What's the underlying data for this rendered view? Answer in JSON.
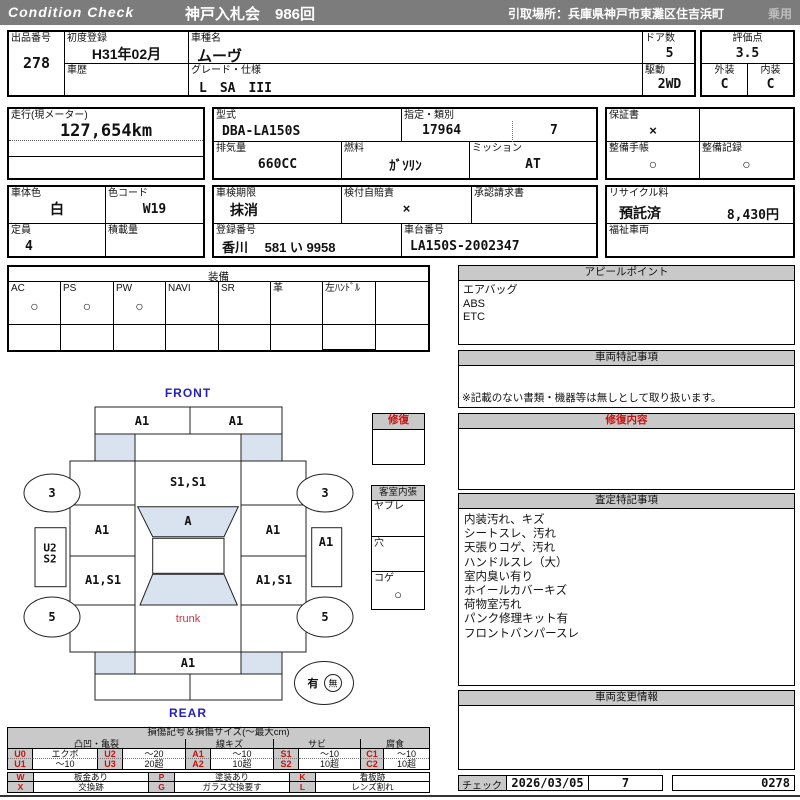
{
  "header": {
    "brand": "Condition  Check",
    "auction": "神戸入札会　986回",
    "pickup": "引取場所：兵庫県神戸市東灘区住吉浜町",
    "category": "乗用"
  },
  "info": {
    "lot_label": "出品番号",
    "lot": "278",
    "first_reg_label": "初度登録",
    "first_reg": "H31年02月",
    "history_label": "車歴",
    "model_name_label": "車種名",
    "model_name": "ムーヴ",
    "grade_label": "グレード・仕様",
    "grade": "L　SA　III",
    "doors_label": "ドア数",
    "doors": "5",
    "drive_label": "駆動",
    "drive": "2WD",
    "score_label": "評価点",
    "score": "3.5",
    "exterior_label": "外装",
    "exterior": "C",
    "interior_label": "内装",
    "interior": "C",
    "mileage_label": "走行(現メーター)",
    "mileage": "127,654km",
    "model_code_label": "型式",
    "model_code": "DBA-LA150S",
    "class_label": "指定・類別",
    "class_1": "17964",
    "class_2": "7",
    "warranty_label": "保証書",
    "warranty": "×",
    "displacement_label": "排気量",
    "displacement": "660CC",
    "fuel_label": "燃料",
    "fuel": "ｶﾞｿﾘﾝ",
    "transmission_label": "ミッション",
    "transmission": "AT",
    "maintenance_book_label": "整備手帳",
    "maintenance_book": "○",
    "maintenance_record_label": "整備記録",
    "maintenance_record": "○",
    "color_label": "車体色",
    "color": "白",
    "color_code_label": "色コード",
    "color_code": "W19",
    "inspection_label": "車検期限",
    "inspection": "抹消",
    "insurance_label": "検付自賠責",
    "insurance": "×",
    "approval_label": "承認請求書",
    "recycle_label": "リサイクル料",
    "recycle_status": "預託済",
    "recycle_fee": "8,430円",
    "capacity_label": "定員",
    "capacity": "4",
    "load_label": "積載量",
    "reg_no_label": "登録番号",
    "reg_no": "香川　 581 い  9958",
    "chassis_label": "車台番号",
    "chassis": "LA150S-2002347",
    "welfare_label": "福祉車両"
  },
  "equipment": {
    "title": "装備",
    "items": [
      {
        "label": "AC",
        "value": "○"
      },
      {
        "label": "PS",
        "value": "○"
      },
      {
        "label": "PW",
        "value": "○"
      },
      {
        "label": "NAVI",
        "value": ""
      },
      {
        "label": "SR",
        "value": ""
      },
      {
        "label": "革",
        "value": ""
      },
      {
        "label": "左ﾊﾝﾄﾞﾙ",
        "value": ""
      },
      {
        "label": "",
        "value": ""
      }
    ]
  },
  "panels": {
    "appeal": {
      "title": "アピールポイント",
      "line1": "エアバッグ",
      "line2": "ABS",
      "line3": "ETC"
    },
    "special": {
      "title": "車両特記事項",
      "note": "※記載のない書類・機器等は無しとして取り扱います。"
    },
    "repair": {
      "title": "修復内容"
    },
    "assessment": {
      "title": "査定特記事項",
      "lines": [
        "内装汚れ、キズ",
        "シートスレ、汚れ",
        "天張りコゲ、汚れ",
        "ハンドルスレ（大）",
        "室内臭い有り",
        "ホイールカバーキズ",
        "荷物室汚れ",
        "パンク修理キット有",
        "フロントバンパースレ"
      ]
    },
    "change": {
      "title": "車両変更情報"
    },
    "check": {
      "label": "チェック",
      "date": "2026/03/05",
      "num": "7",
      "code": "0278"
    }
  },
  "diagram": {
    "front_label": "FRONT",
    "rear_label": "REAR",
    "bumper_fl": "A1",
    "bumper_fr": "A1",
    "windshield": "S1,S1",
    "door_fl": "A1",
    "roof": "A",
    "door_fr": "A1",
    "door_rl": "A1,S1",
    "door_rr": "A1,S1",
    "sill_l1": "U2",
    "sill_l2": "S2",
    "sill_r": "A1",
    "wheel_fl": "3",
    "wheel_fr": "3",
    "wheel_rl": "5",
    "wheel_rr": "5",
    "trunk": "trunk",
    "rear_panel": "A1",
    "tools_yes": "有",
    "tools_no": "無",
    "repair_box_title": "修復",
    "cabin_title": "客室内張",
    "cabin_rows": [
      {
        "label": "ヤブレ",
        "value": ""
      },
      {
        "label": "穴",
        "value": ""
      },
      {
        "label": "コゲ",
        "value": "○"
      }
    ]
  },
  "legend": {
    "title": "損傷記号＆損傷サイズ(～最大cm)",
    "groups": [
      "凸凹・亀裂",
      "線キズ",
      "サビ",
      "腐食"
    ],
    "rowA": [
      [
        "U0",
        "エクボ"
      ],
      [
        "U2",
        "～20"
      ],
      [
        "A1",
        "～10"
      ],
      [
        "S1",
        "～10"
      ],
      [
        "C1",
        "～10"
      ]
    ],
    "rowB": [
      [
        "U1",
        "～10"
      ],
      [
        "U3",
        "20超"
      ],
      [
        "A2",
        "10超"
      ],
      [
        "S2",
        "10超"
      ],
      [
        "C2",
        "10超"
      ]
    ],
    "marksA": [
      [
        "W",
        "板金あり"
      ],
      [
        "P",
        "塗装あり"
      ],
      [
        "K",
        "看板跡"
      ]
    ],
    "marksB": [
      [
        "X",
        "交換跡"
      ],
      [
        "G",
        "ガラス交換要す"
      ],
      [
        "L",
        "レンズ割れ"
      ]
    ]
  },
  "colors": {
    "accent_blue": "#2222bb",
    "accent_red": "#cc1111",
    "glass_blue": "#d9e3f0",
    "header_grey": "#7c7c7c"
  }
}
